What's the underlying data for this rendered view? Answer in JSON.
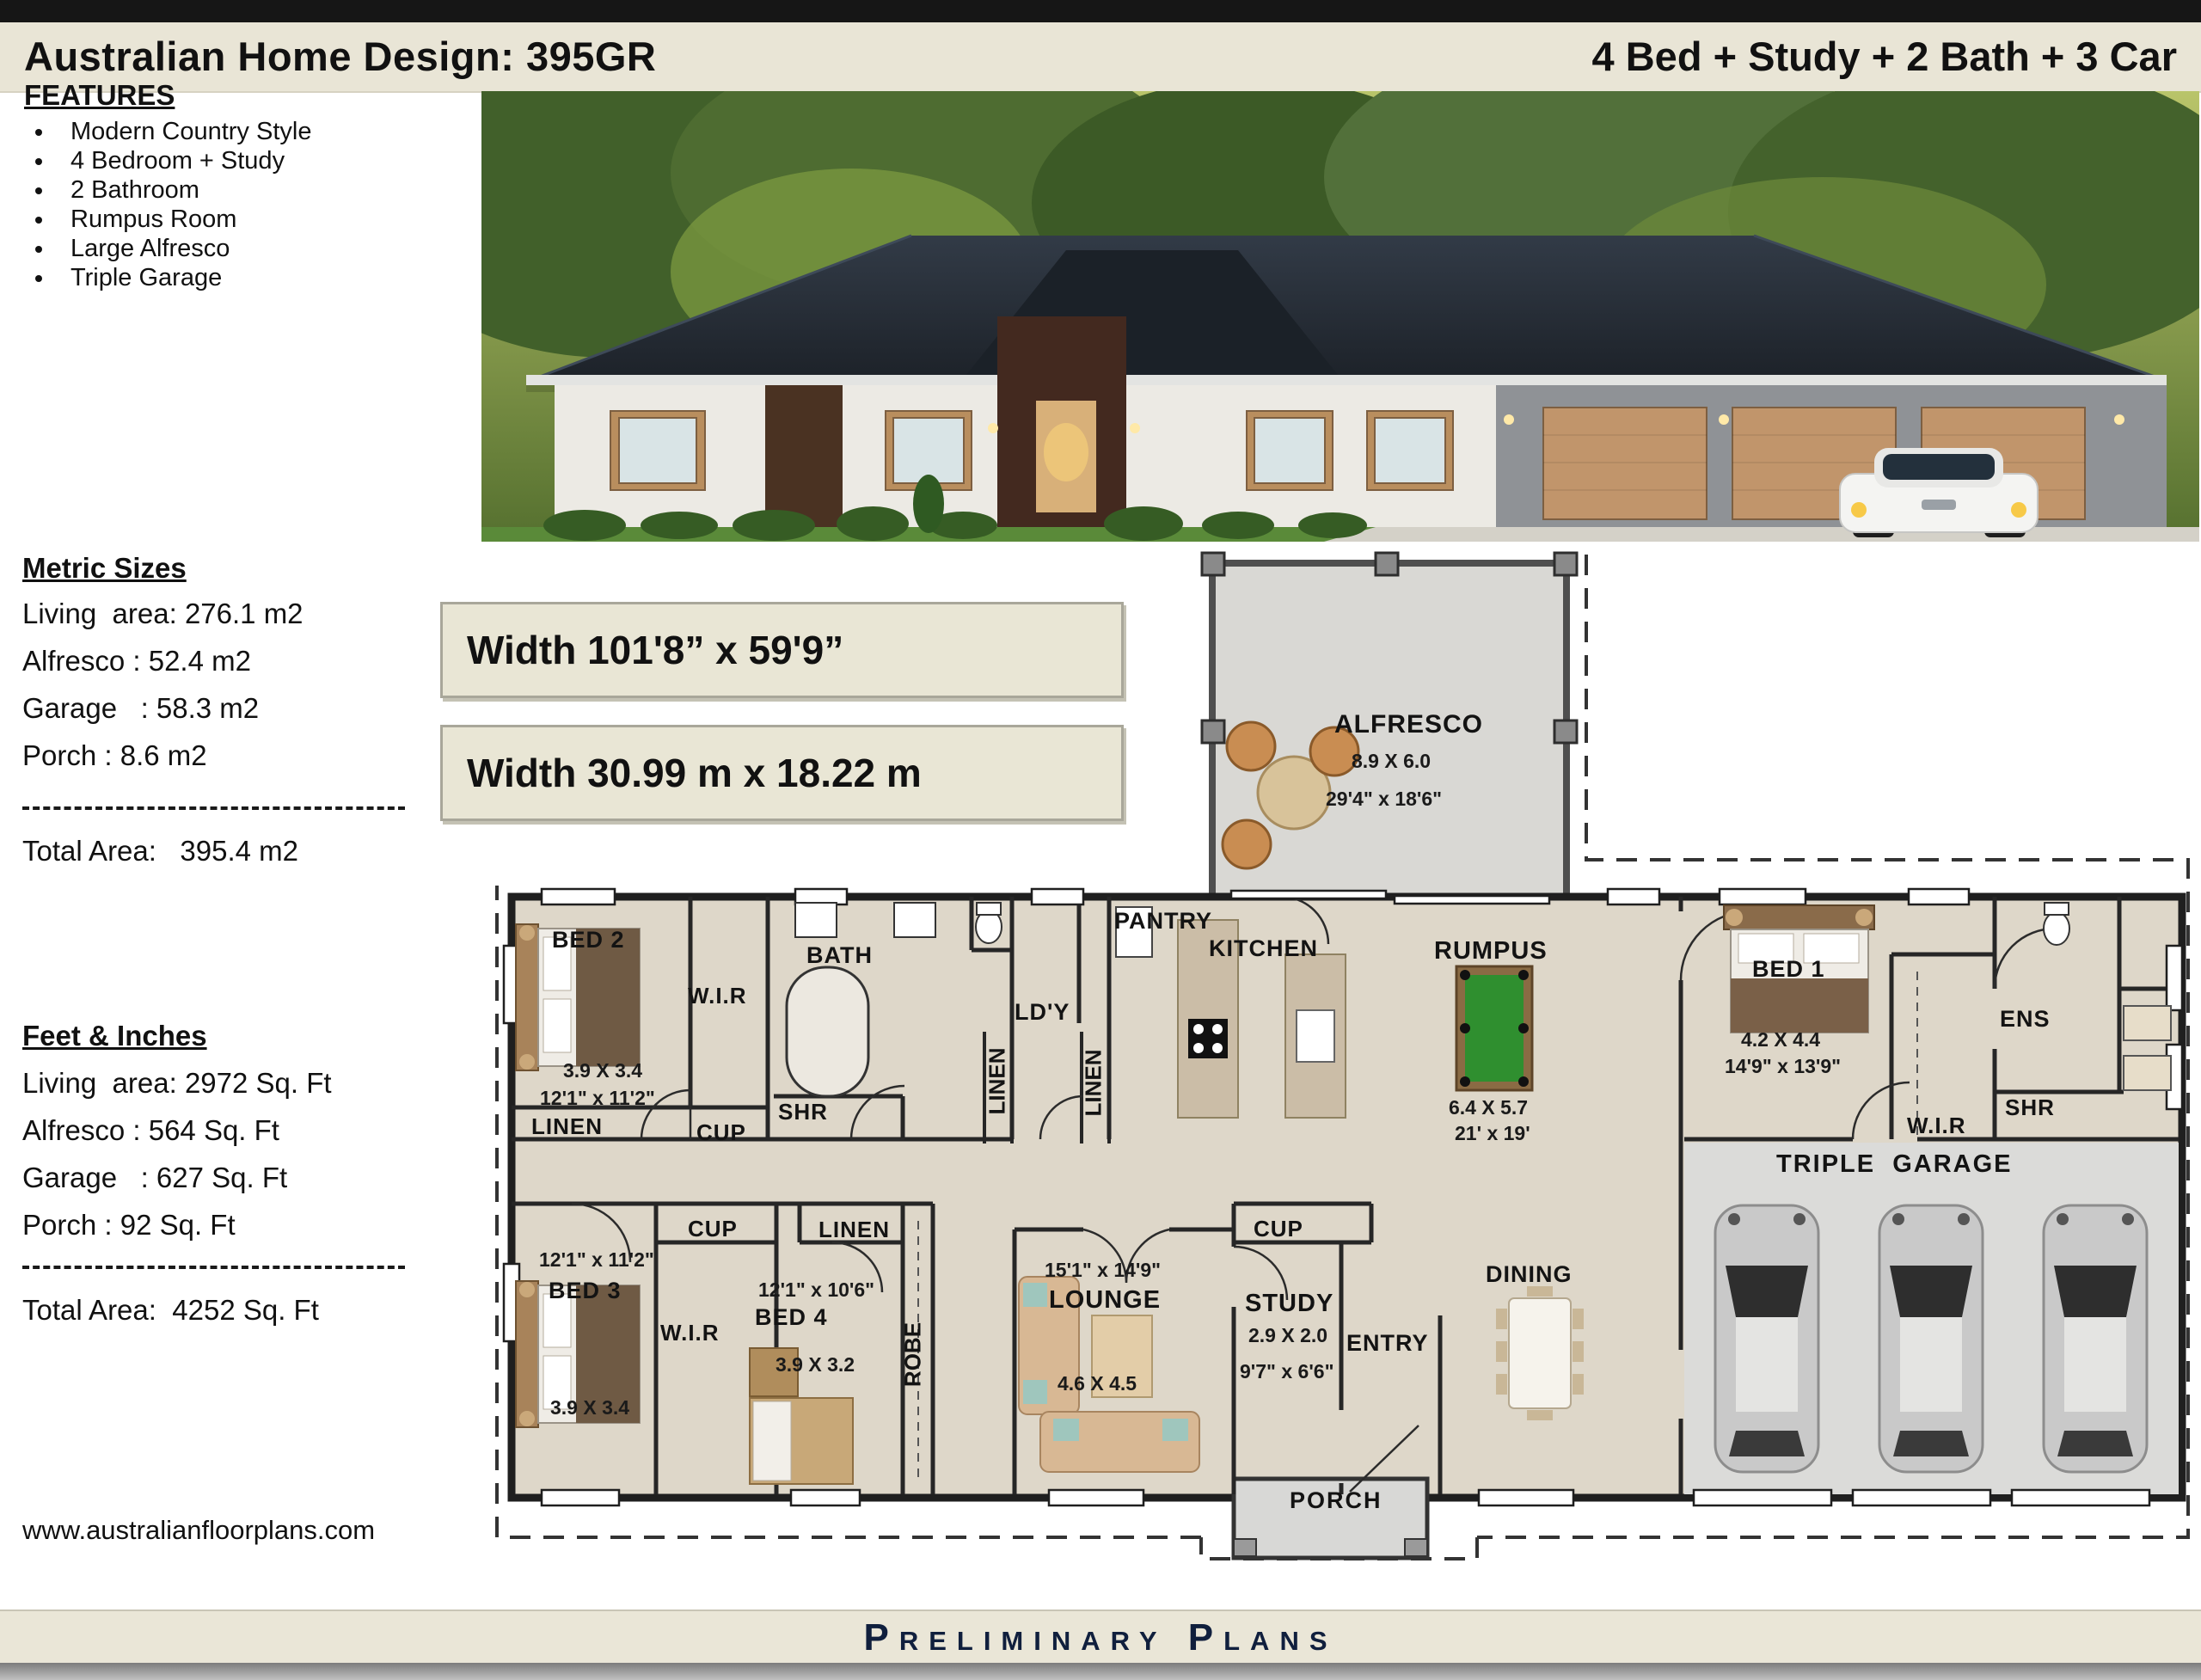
{
  "header": {
    "title": "Australian Home Design: 395GR",
    "subtitle": "4 Bed + Study + 2 Bath + 3 Car"
  },
  "features": {
    "heading": "FEATURES",
    "items": [
      "Modern Country Style",
      "4 Bedroom + Study",
      "2 Bathroom",
      "Rumpus Room",
      "Large Alfresco",
      "Triple Garage"
    ]
  },
  "metric": {
    "heading": "Metric Sizes",
    "lines": [
      "Living  area: 276.1 m2",
      "Alfresco : 52.4 m2",
      "Garage   : 58.3 m2",
      "Porch : 8.6 m2"
    ],
    "total": "Total Area:   395.4 m2"
  },
  "imperial": {
    "heading": "Feet & Inches",
    "lines": [
      "Living  area: 2972 Sq. Ft",
      "Alfresco : 564 Sq. Ft",
      "Garage   : 627 Sq. Ft",
      "Porch : 92 Sq. Ft"
    ],
    "total": "Total Area:  4252 Sq. Ft"
  },
  "dimensions": {
    "imperial": "Width 101'8”  x 59'9”",
    "metric": "Width 30.99 m x 18.22 m"
  },
  "website": "www.australianfloorplans.com",
  "footer": {
    "label": "Preliminary Plans"
  },
  "plan": {
    "labels": {
      "alfresco": {
        "name": "ALFRESCO",
        "metric": "8.9 X 6.0",
        "imperial": "29'4\" x 18'6\""
      },
      "bed2": {
        "name": "BED 2",
        "metric": "3.9 X 3.4",
        "imperial": "12'1\" x 11'2\""
      },
      "linen1": {
        "name": "LINEN"
      },
      "wir2": {
        "name": "W.I.R"
      },
      "bath": {
        "name": "BATH"
      },
      "shr1": {
        "name": "SHR"
      },
      "cup1": {
        "name": "CUP"
      },
      "ldy": {
        "name": "LD'Y"
      },
      "pantry": {
        "name": "PANTRY"
      },
      "kitchen": {
        "name": "KITCHEN"
      },
      "linen2": {
        "name": "LINEN"
      },
      "linen3": {
        "name": "LINEN"
      },
      "rumpus": {
        "name": "RUMPUS",
        "metric": "6.4 X 5.7",
        "imperial": "21' x 19'"
      },
      "bed1": {
        "name": "BED 1",
        "metric": "4.2 X 4.4",
        "imperial": "14'9\" x 13'9\""
      },
      "ens": {
        "name": "ENS"
      },
      "wir1": {
        "name": "W.I.R"
      },
      "shr2": {
        "name": "SHR"
      },
      "garage": {
        "name": "TRIPLE  GARAGE"
      },
      "cup2": {
        "name": "CUP"
      },
      "linen4": {
        "name": "LINEN"
      },
      "bed3": {
        "name": "BED 3",
        "metric": "3.9 X 3.4",
        "imperial": "12'1\" x 11'2\""
      },
      "wir3": {
        "name": "W.I.R"
      },
      "bed4": {
        "name": "BED 4",
        "metric": "3.9 X 3.2",
        "imperial": "12'1\" x 10'6\""
      },
      "robe": {
        "name": "ROBE"
      },
      "lounge": {
        "name": "LOUNGE",
        "metric": "4.6 X 4.5",
        "imperial": "15'1\" x 14'9\""
      },
      "cup3": {
        "name": "CUP"
      },
      "study": {
        "name": "STUDY",
        "metric": "2.9 X 2.0",
        "imperial": "9'7\" x 6'6\""
      },
      "entry": {
        "name": "ENTRY"
      },
      "dining": {
        "name": "DINING"
      },
      "porch": {
        "name": "PORCH"
      }
    }
  }
}
